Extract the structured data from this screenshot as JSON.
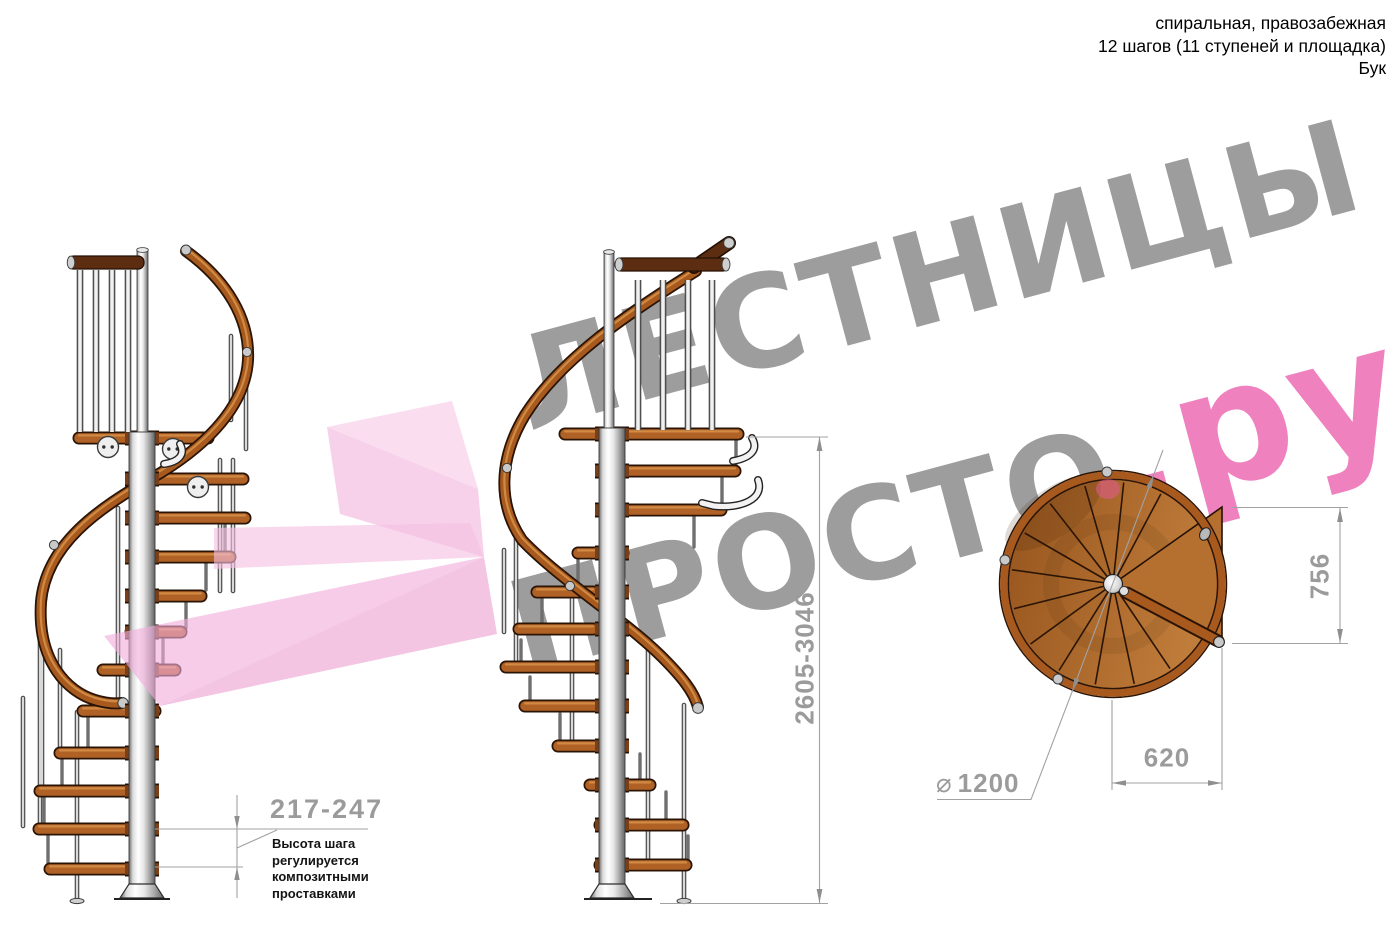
{
  "header": {
    "line1": "спиральная, правозабежная",
    "line2": "12 шагов (11 ступеней и площадка)",
    "line3": "Бук"
  },
  "watermark": {
    "word1": "ЛЕСТНИЦЫ",
    "word2": "ПРОСТО",
    "word3": ".ру"
  },
  "dimensions": {
    "total_height": "2605-3046",
    "platform_depth": "756",
    "platform_width": "620",
    "diameter_symbol": "⌀",
    "diameter": "1200",
    "step_height": "217-247",
    "step_height_note": "Высота шага\nрегулируется\nкомпозитными\nпроставками"
  },
  "colors": {
    "watermark_gray": "#9d9d9d",
    "watermark_pink": "#ef82be",
    "logo_pink": "#f2b5dd",
    "dimension_gray": "#9b9b9b",
    "wood": "#a85a1e",
    "wood_dark": "#2a1405",
    "metal_light": "#d9d9d9"
  }
}
